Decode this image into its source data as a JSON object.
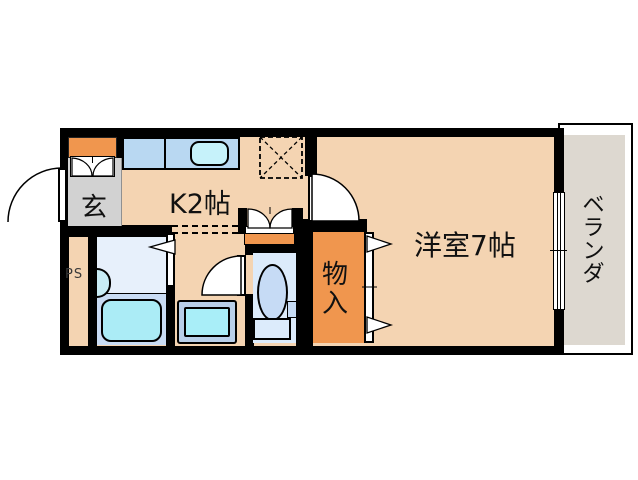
{
  "rooms": {
    "entrance": {
      "label": "玄"
    },
    "kitchen": {
      "label": "K2帖"
    },
    "western_room": {
      "label": "洋室7帖"
    },
    "closet": {
      "label": "物入",
      "chars": [
        "物",
        "入"
      ]
    },
    "veranda": {
      "label": "ベランダ",
      "chars": [
        "ベ",
        "ラ",
        "ン",
        "ダ"
      ]
    },
    "pipe_space": {
      "label": "PS"
    }
  },
  "fixtures": [
    "shoe-cabinet",
    "entrance-door",
    "kitchen-counter",
    "kitchen-sink",
    "refrigerator-space",
    "washbasin-alcove",
    "bathroom",
    "bathtub",
    "bath-washbasin",
    "bathroom-folding-door",
    "washing-machine-pan",
    "toilet",
    "toilet-door",
    "storage-closet",
    "closet-folding-doors",
    "room-door",
    "balcony-window",
    "pipe-space"
  ],
  "colors": {
    "wall": "#000000",
    "floor_tan": "#f4d4b2",
    "accent_orange": "#f0964e",
    "entrance_gray": "#d2d2d2",
    "veranda_gray": "#ddd8d0",
    "counter_blue": "#b9d8f2",
    "fixture_cyan": "#abecf6",
    "bathroom_blue": "#e7f0fb",
    "toilet_blue": "#dcebfb"
  }
}
